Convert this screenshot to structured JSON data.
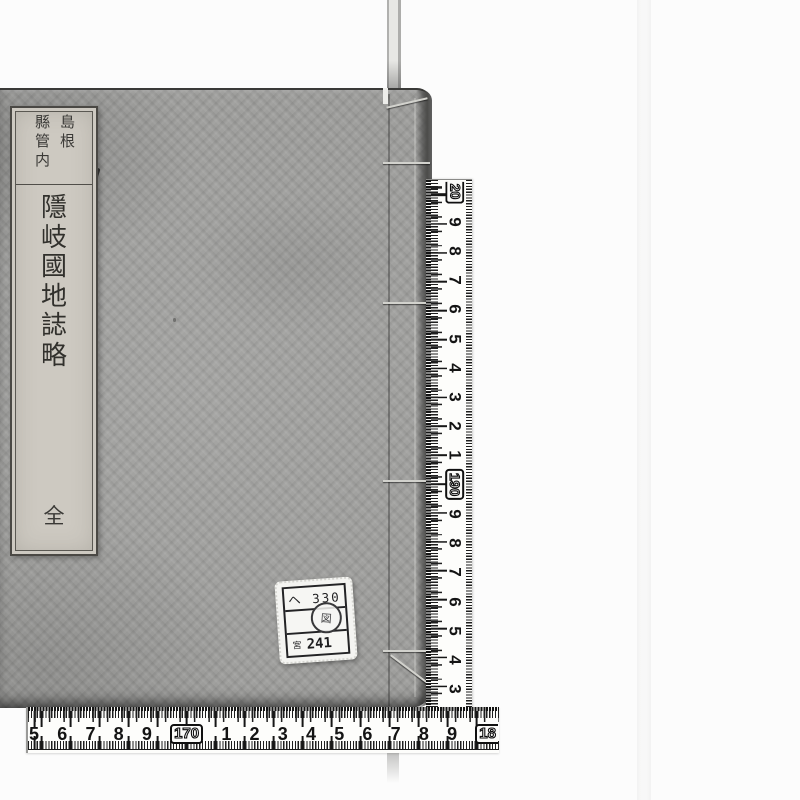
{
  "scene": {
    "background_color": "#fcfcfc",
    "book_cover_color": "#9e9e9c",
    "title_slip_color": "#cdc9c1",
    "ruler_color": "#fdfdfb",
    "ink_color": "#141414"
  },
  "book": {
    "title_slip": {
      "header_col_right": "島根",
      "header_col_left": "縣管内",
      "title": "隱岐國地誌略",
      "title_chars": [
        "隱",
        "岐",
        "國",
        "地",
        "誌",
        "略"
      ],
      "volume_mark": "全"
    },
    "call_label": {
      "row1": "ヘ 330",
      "row3_prefix": "宮",
      "row3_number": "241",
      "seal_char": "図"
    }
  },
  "rulers": {
    "vertical_labels": [
      {
        "t": "20",
        "boxed": "true"
      },
      {
        "t": "9"
      },
      {
        "t": "8"
      },
      {
        "t": "7"
      },
      {
        "t": "6"
      },
      {
        "t": "5"
      },
      {
        "t": "4"
      },
      {
        "t": "3"
      },
      {
        "t": "2"
      },
      {
        "t": "1"
      },
      {
        "t": "190",
        "boxed": "true"
      },
      {
        "t": "9"
      },
      {
        "t": "8"
      },
      {
        "t": "7"
      },
      {
        "t": "6"
      },
      {
        "t": "5"
      },
      {
        "t": "4"
      },
      {
        "t": "3"
      },
      {
        "t": "2"
      }
    ],
    "horizontal_labels": [
      {
        "t": "5"
      },
      {
        "t": "6"
      },
      {
        "t": "7"
      },
      {
        "t": "8"
      },
      {
        "t": "9"
      },
      {
        "t": "170",
        "boxed": "true"
      },
      {
        "t": "1"
      },
      {
        "t": "2"
      },
      {
        "t": "3"
      },
      {
        "t": "4"
      },
      {
        "t": "5"
      },
      {
        "t": "6"
      },
      {
        "t": "7"
      },
      {
        "t": "8"
      },
      {
        "t": "9"
      },
      {
        "t": "18",
        "boxed": "true"
      }
    ]
  }
}
